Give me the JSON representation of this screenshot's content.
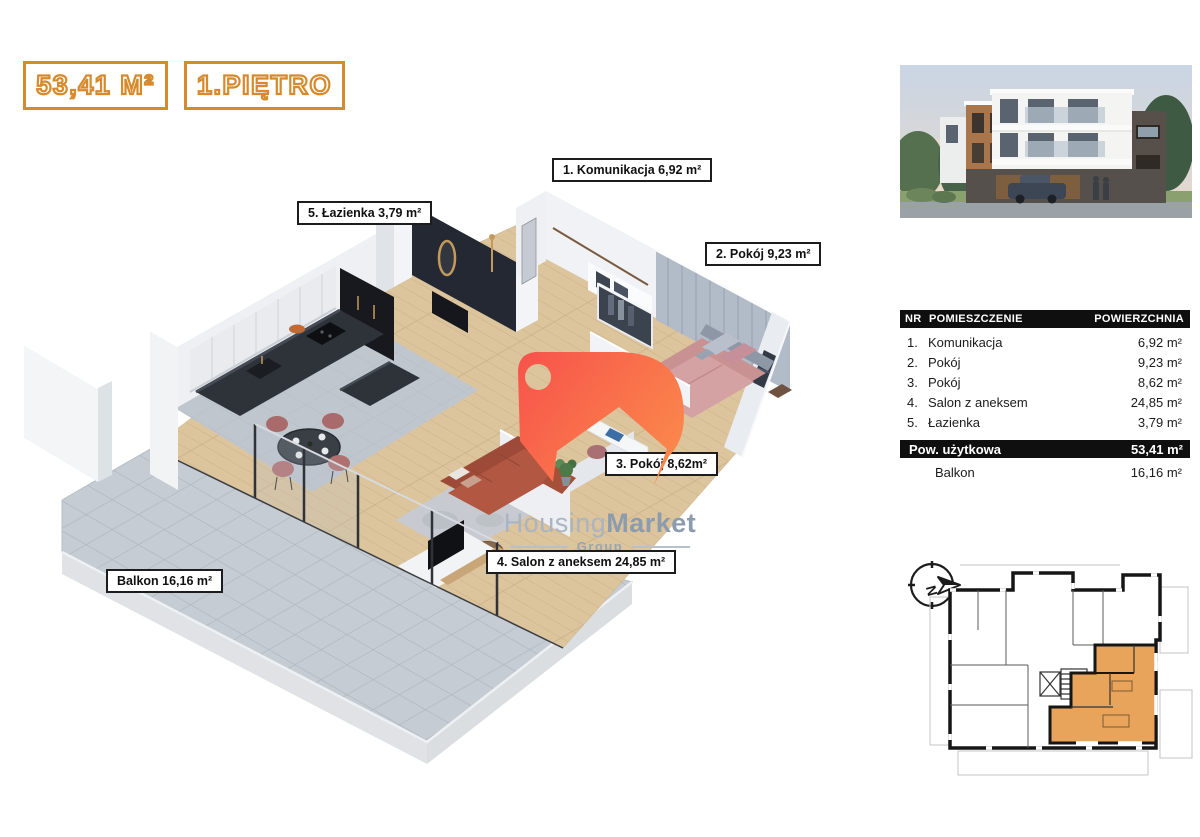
{
  "badges": {
    "accent_color": "#d78a2c",
    "area_label": "53,41 M²",
    "floor_label": "1.PIĘTRO"
  },
  "plan3d": {
    "labels": [
      {
        "text": "1. Komunikacja 6,92 m²"
      },
      {
        "text": "5. Łazienka 3,79 m²"
      },
      {
        "text": "2. Pokój 9,23 m²"
      },
      {
        "text": "3. Pokój 8,62m²"
      },
      {
        "text": "4. Salon z aneksem 24,85 m²"
      },
      {
        "text": "Balkon 16,16 m²"
      }
    ]
  },
  "logo": {
    "brand_light": "Housing",
    "brand_bold": "Market",
    "subtitle": "Group",
    "tag_gradient_start": "#f7524b",
    "tag_gradient_end": "#fb8e4b",
    "text_color": "#a3b0bd"
  },
  "table": {
    "header_bg": "#0f0f0f",
    "headers": {
      "nr": "NR",
      "room": "POMIESZCZENIE",
      "area": "POWIERZCHNIA"
    },
    "rows": [
      {
        "nr": "1.",
        "room": "Komunikacja",
        "area": "6,92 m²"
      },
      {
        "nr": "2.",
        "room": "Pokój",
        "area": "9,23 m²"
      },
      {
        "nr": "3.",
        "room": "Pokój",
        "area": "8,62 m²"
      },
      {
        "nr": "4.",
        "room": "Salon z aneksem",
        "area": "24,85 m²"
      },
      {
        "nr": "5.",
        "room": "Łazienka",
        "area": "3,79 m²"
      }
    ],
    "summary": {
      "label": "Pow. użytkowa",
      "value": "53,41 m²"
    },
    "extra": {
      "label": "Balkon",
      "value": "16,16 m²"
    }
  },
  "schematic": {
    "compass_letter": "N",
    "highlight_color": "#e9a45b"
  }
}
